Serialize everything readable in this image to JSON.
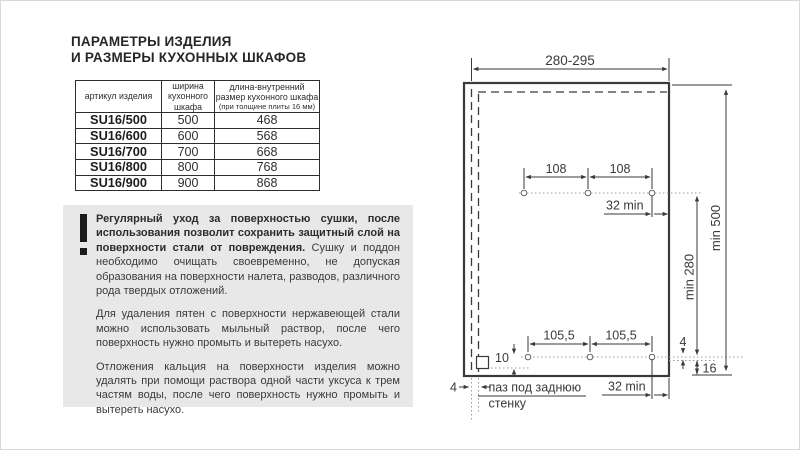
{
  "page": {
    "title_line1": "ПАРАМЕТРЫ ИЗДЕЛИЯ",
    "title_line2": "И РАЗМЕРЫ КУХОННЫХ ШКАФОВ"
  },
  "table": {
    "headers": {
      "col1": "артикул изделия",
      "col2": "ширина кухонного шкафа",
      "col3_main": "длина-внутренний размер кухонного шкафа",
      "col3_sub": "(при толщине плиты 16 мм)"
    },
    "rows": [
      {
        "art": "SU16/500",
        "width": "500",
        "length": "468"
      },
      {
        "art": "SU16/600",
        "width": "600",
        "length": "568"
      },
      {
        "art": "SU16/700",
        "width": "700",
        "length": "668"
      },
      {
        "art": "SU16/800",
        "width": "800",
        "length": "768"
      },
      {
        "art": "SU16/900",
        "width": "900",
        "length": "868"
      }
    ]
  },
  "notice": {
    "icon": "exclamation-mark",
    "p1_bold": "Регулярный уход за поверхностью сушки, после использования позволит сохранить защитный слой на поверхности стали от повреждения.",
    "p1_rest": " Сушку и поддон необходимо очищать своевременно, не допуская образования на поверхности налета, разводов, различного рода твердых отложений.",
    "p2": "Для удаления пятен с поверхности нержавеющей стали можно использовать мыльный раствор, после чего поверхность нужно промыть и вытереть насухо.",
    "p3": "Отложения кальция на поверхности изделия можно удалять при помощи раствора одной части уксуса к трем частям воды, после чего поверхность нужно промыть и вытереть насухо."
  },
  "drawing": {
    "dim_width": "280-295",
    "dim_top_spacing_left": "108",
    "dim_top_spacing_right": "108",
    "dim_front_offset_top": "32 min",
    "dim_height": "min 500",
    "dim_rows_distance": "min 280",
    "dim_bottom_spacing_left": "105,5",
    "dim_bottom_spacing_right": "105,5",
    "dim_hole_line_gap": "4",
    "dim_bottom_edge": "16",
    "dim_groove_offset": "10",
    "dim_groove_width": "4",
    "groove_label_line1": "паз под заднюю",
    "groove_label_line2": "стенку",
    "dim_front_offset_bottom": "32 min"
  },
  "colors": {
    "notice_bg": "#e8e8e8",
    "line": "#3a3a3a",
    "text": "#3a3a3a"
  }
}
